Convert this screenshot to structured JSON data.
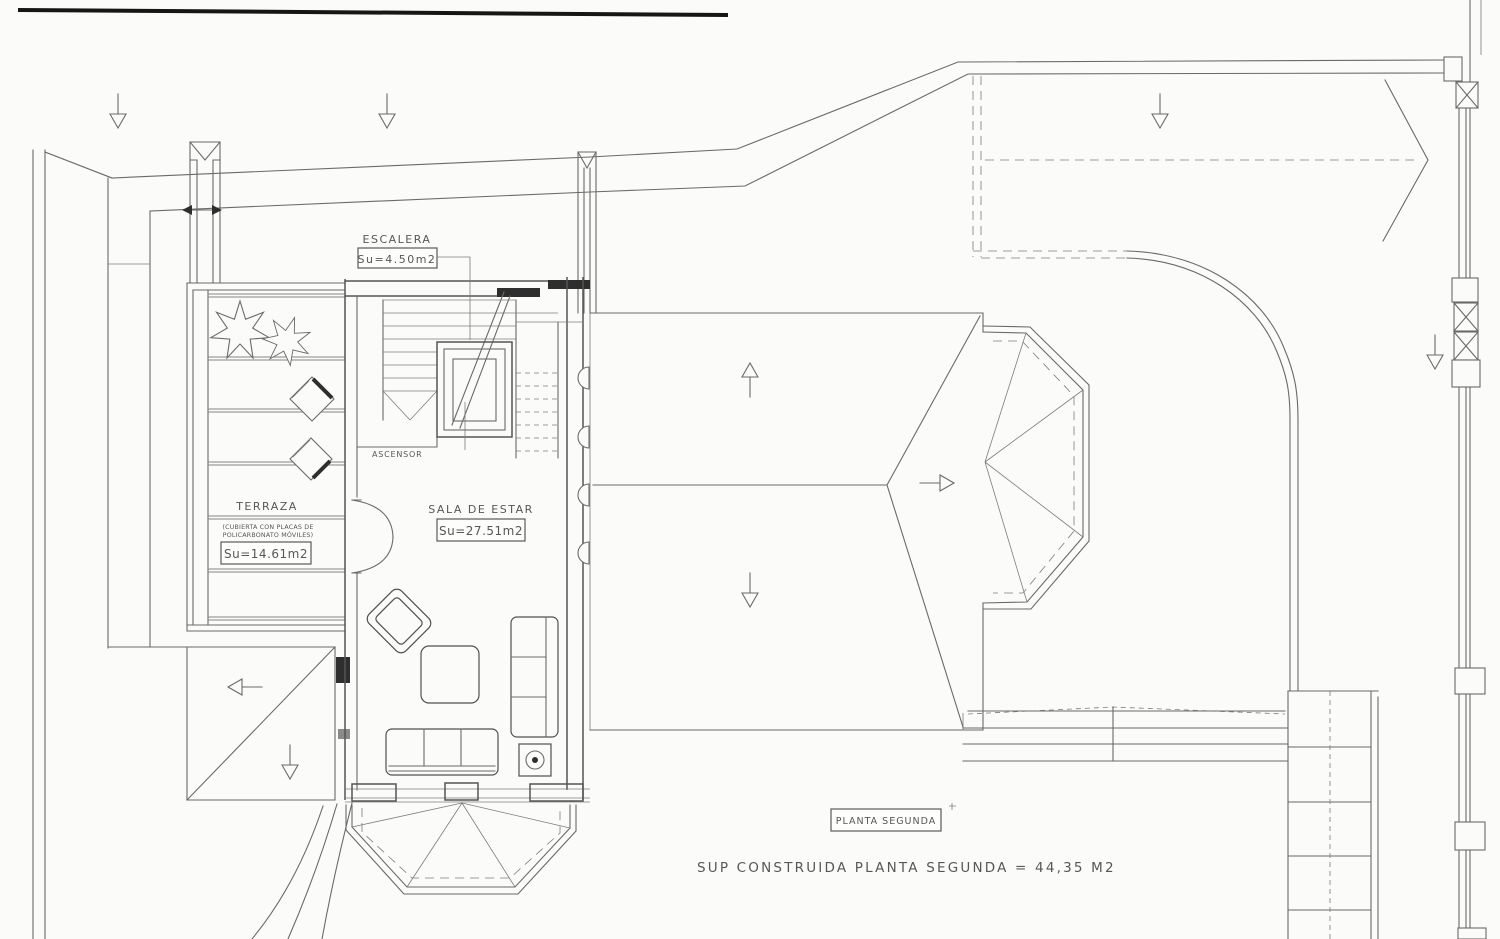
{
  "doc": {
    "plan_title": "PLANTA SEGUNDA",
    "summary": "SUP CONSTRUIDA PLANTA SEGUNDA = 44,35 M2",
    "labels": {
      "escalera": {
        "title": "ESCALERA",
        "area": "Su=4.50m2"
      },
      "ascensor": {
        "title": "ASCENSOR"
      },
      "terraza": {
        "title": "TERRAZA",
        "note1": "(CUBIERTA CON PLACAS DE",
        "note2": "POLICARBONATO MÓVILES)",
        "area": "Su=14.61m2"
      },
      "sala": {
        "title": "SALA DE ESTAR",
        "area": "Su=27.51m2"
      }
    },
    "colors": {
      "paper": "#fbfbf9",
      "ink": "#666666",
      "ink_dark": "#2e2e2e",
      "scan_edge": "#161616"
    }
  }
}
